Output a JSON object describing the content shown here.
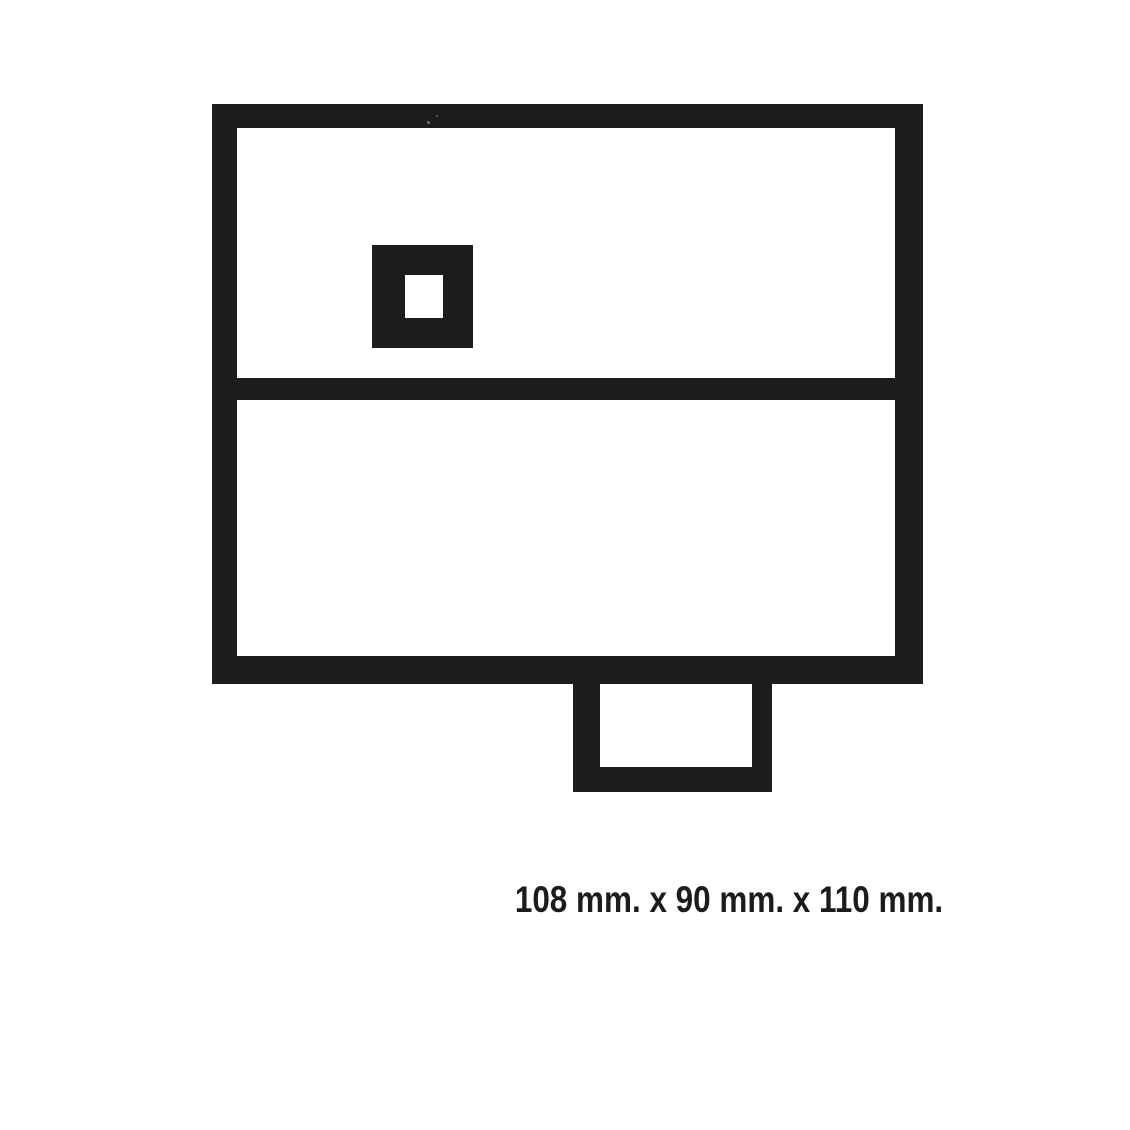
{
  "page": {
    "background": "#ffffff"
  },
  "colors": {
    "ink": "#1d1b1c"
  },
  "diagram": {
    "description": "technical-dimension-drawing",
    "shapes": [
      "outer-box",
      "divider-bar",
      "port-square",
      "port-hole",
      "bottom-tab",
      "bottom-tab-hole"
    ]
  },
  "caption": {
    "text": "108 mm. x 90 mm. x 110 mm."
  }
}
